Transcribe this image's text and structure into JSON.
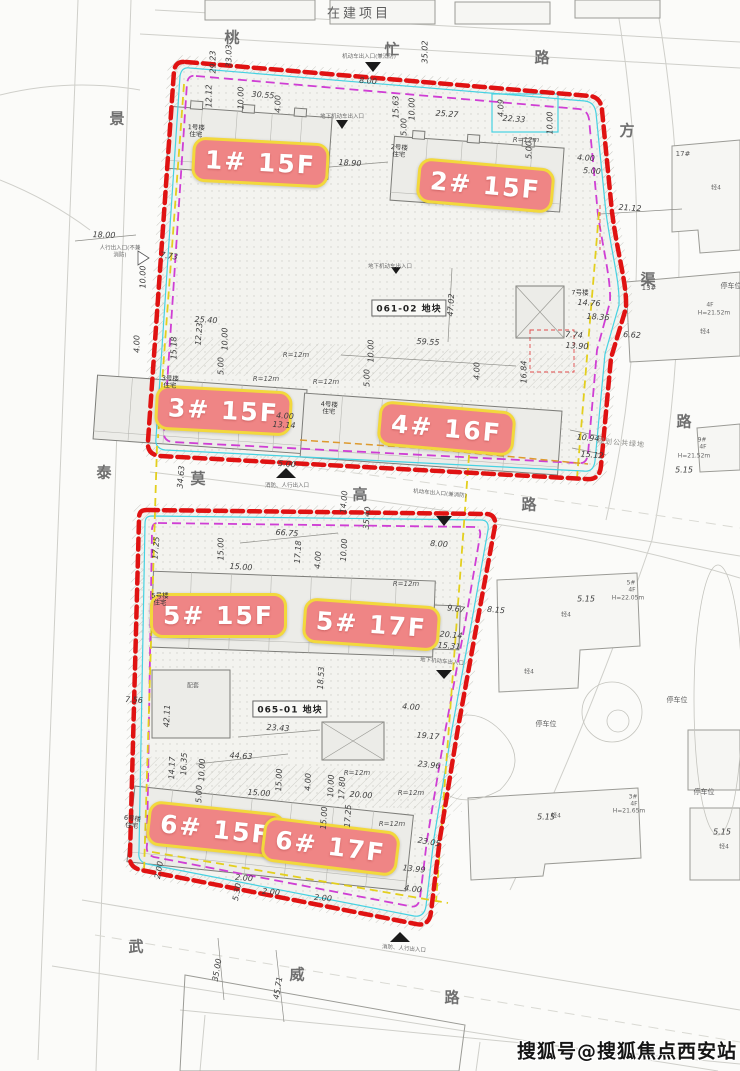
{
  "header": {
    "construction_project": "在建项目"
  },
  "watermark": {
    "text": "搜狐号@搜狐焦点西安站"
  },
  "streets": [
    "桃",
    "忙",
    "路",
    "景",
    "方",
    "渠",
    "泰",
    "莫",
    "高",
    "路",
    "路",
    "武",
    "威",
    "路"
  ],
  "parcels": [
    "061-02 地块",
    "065-01 地块"
  ],
  "tower_tags": [
    "1# 15F",
    "2# 15F",
    "3# 15F",
    "4# 16F",
    "5# 15F",
    "5# 17F",
    "6# 15F",
    "6# 17F"
  ],
  "units": [
    {
      "name": "1号楼",
      "type": "住宅"
    },
    {
      "name": "2号楼",
      "type": "住宅"
    },
    {
      "name": "3号楼",
      "type": "住宅"
    },
    {
      "name": "4号楼",
      "type": "住宅"
    },
    {
      "name": "5号楼",
      "type": "住宅"
    },
    {
      "name": "6号楼",
      "type": "住宅"
    },
    {
      "name": "7号楼",
      "type": ""
    }
  ],
  "facility_labels": {
    "peitao": "配套",
    "green": "规划公共绿地",
    "parking": "停车位",
    "jing4": "轻4"
  },
  "context_buildings": {
    "b17": "17#",
    "b13": "13#",
    "b9": "9#",
    "b5": "5#",
    "b3": "3#",
    "f4": "4F",
    "h2152": "H=21.52m",
    "h2205": "H=22.05m",
    "h2165": "H=21.65m"
  },
  "entrances": [
    "机动车出入口(兼消防)",
    "地下机动车出入口",
    "人行出入口(不兼消防)",
    "消防、人行出入口"
  ],
  "radius_note": "R=12m",
  "dims": [
    "29.23",
    "33.03",
    "12.12",
    "10.00",
    "30.55",
    "4.00",
    "8.00",
    "35.02",
    "15.63",
    "10.00",
    "25.27",
    "4.09",
    "22.33",
    "10.00",
    "18.90",
    "5.00",
    "5.00",
    "21.12",
    "4.00",
    "5.00",
    "18.00",
    "10.00",
    "7.73",
    "25.40",
    "12.23",
    "15.18",
    "10.00",
    "5.00",
    "4.00",
    "59.55",
    "47.02",
    "10.00",
    "5.00",
    "4.00",
    "16.84",
    "14.76",
    "18.36",
    "7.74",
    "6.62",
    "13.90",
    "4.00",
    "13.14",
    "10.94",
    "15.12",
    "34.63",
    "5.00",
    "14.00",
    "35.40",
    "66.75",
    "17.25",
    "15.00",
    "15.00",
    "17.18",
    "4.00",
    "10.00",
    "8.00",
    "9.67",
    "8.15",
    "20.14",
    "15.31",
    "18.53",
    "42.11",
    "23.43",
    "4.00",
    "19.17",
    "23.96",
    "44.63",
    "14.17",
    "16.35",
    "10.00",
    "15.00",
    "4.00",
    "10.00",
    "17.80",
    "20.00",
    "15.00",
    "5.00",
    "17.25",
    "15.00",
    "23.05",
    "13.99",
    "4.00",
    "2.00",
    "2.00",
    "5.30",
    "2.00",
    "2.00",
    "35.00",
    "45.71",
    "7.56",
    "5.15",
    "5.15",
    "5.15",
    "5.15"
  ],
  "colors": {
    "boundary_red": "#e01212",
    "magenta_dash": "#cf3ed4",
    "yellow_dash": "#e3cf1d",
    "cyan_line": "#46d2e2",
    "orange_dash": "#dd9a2e",
    "tag_bg": "#ef8585",
    "tag_border": "#f2d83c",
    "tag_text": "#ffffff"
  }
}
